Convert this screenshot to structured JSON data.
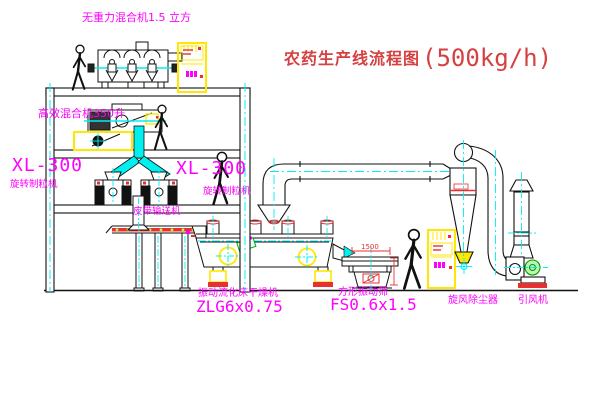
{
  "title": {
    "name_cn": "农药生产线流程图",
    "capacity": "(500kg/h)"
  },
  "labels": {
    "top_mixer": "无重力混合机1.5 立方",
    "wet_mixer": "高效混合机350升",
    "granulator_left_model": "XL-300",
    "granulator_left_name": "旋转制粒机",
    "granulator_right_model": "XL-300",
    "granulator_right_name": "旋转制粒机",
    "belt_conveyor": "皮带输送机",
    "dryer_name": "振动流化床干燥机",
    "dryer_model": "ZLG6x0.75",
    "screen_name": "方形振动筛",
    "screen_model": "FS0.6x1.5",
    "cyclone": "旋风除尘器",
    "fan": "引风机",
    "screen_dim": "1500"
  },
  "colors": {
    "label_magenta": "#FF00FF",
    "title_red": "#D64040",
    "annotation_red": "#E83030",
    "centerline_cyan": "#00F0F0",
    "equipment_yellow": "#FFE800",
    "motor_green": "#00AA00",
    "line_black": "#111111"
  }
}
